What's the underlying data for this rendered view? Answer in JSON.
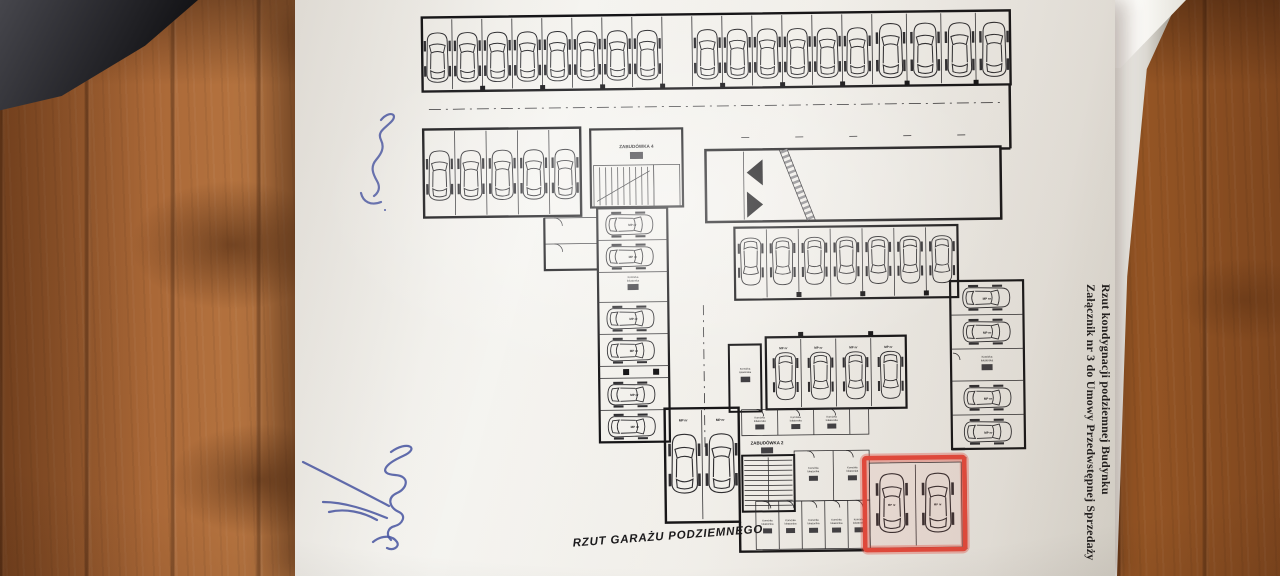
{
  "photo": {
    "surface_wood_color": "#a96a38",
    "dark_object_color": "#232327",
    "paper_color": "#f4f3ef"
  },
  "document": {
    "plan_title": "RZUT GARAŻU PODZIEMNEGO",
    "side_caption_line1": "Rzut kondygnacji podziemnej Budynku",
    "side_caption_line2": "Załącznik nr 3 do Umowy Przedwstępnej Sprzedaży"
  },
  "plan": {
    "ink_color": "#1d1d1f",
    "highlight_color": "#e8483c",
    "stairwell_top_label": "ZABUDÓWKA 4",
    "stairwell_bottom_label": "ZABUDÓWKA 2",
    "storage_room_line1": "Komórka",
    "storage_room_line2": "lokatorska",
    "parking_space_prefix": "MP nr",
    "highlighted_spaces": 2,
    "parking_groups": [
      {
        "name": "top-row",
        "spaces": 19,
        "orientation": "vertical"
      },
      {
        "name": "left-cluster",
        "spaces": 5,
        "orientation": "vertical"
      },
      {
        "name": "middle-row",
        "spaces": 7,
        "orientation": "vertical"
      },
      {
        "name": "mid-left-column",
        "spaces": 6,
        "orientation": "horizontal"
      },
      {
        "name": "right-column",
        "spaces": 4,
        "orientation": "horizontal"
      },
      {
        "name": "center-cluster",
        "spaces": 4,
        "orientation": "vertical"
      },
      {
        "name": "bottom-left-pair",
        "spaces": 2,
        "orientation": "vertical"
      },
      {
        "name": "highlighted-pair",
        "spaces": 2,
        "orientation": "vertical",
        "highlighted": true
      }
    ]
  },
  "annotations": {
    "pen_color": "#4a58a4"
  }
}
